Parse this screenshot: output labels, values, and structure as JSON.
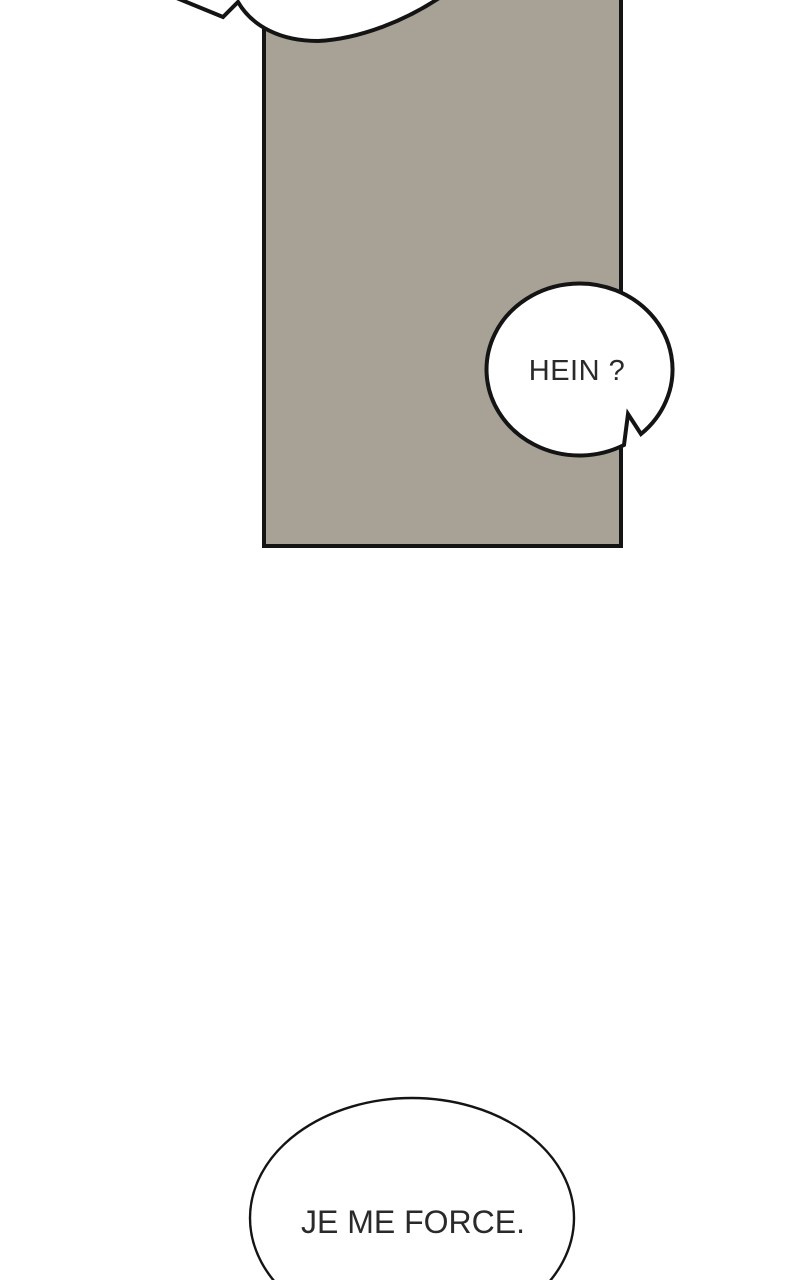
{
  "colors": {
    "background": "#ffffff",
    "panel_fill": "#a8a296",
    "outline": "#141414",
    "bubble_fill": "#ffffff",
    "text_color": "#2a2a2a"
  },
  "bubbles": {
    "hein": {
      "text": "HEIN ?"
    },
    "bottom": {
      "text": "JE ME FORCE."
    }
  }
}
